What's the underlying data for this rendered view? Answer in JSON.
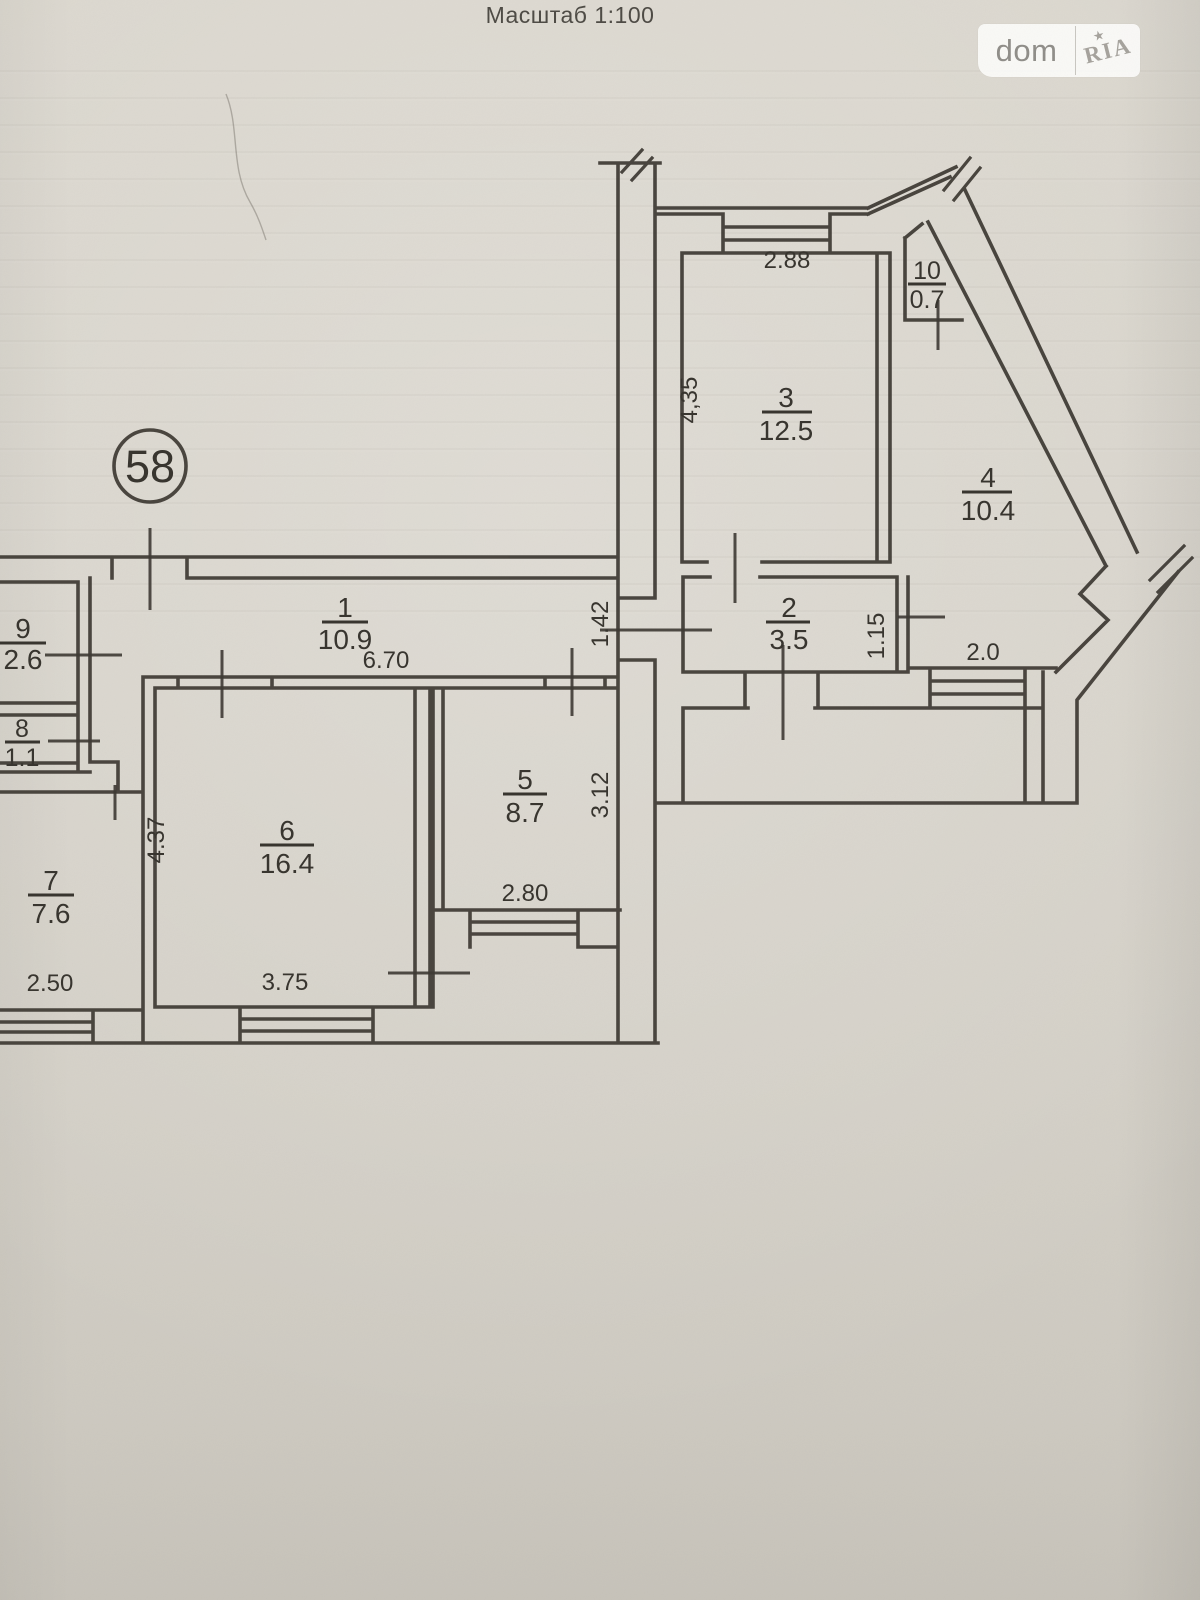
{
  "title": "Масштаб 1:100",
  "watermark": {
    "left": "dom",
    "right": "RIA",
    "star": "★"
  },
  "apartment_badge": "58",
  "rooms": [
    {
      "number": "1",
      "area": "10.9"
    },
    {
      "number": "2",
      "area": "3.5"
    },
    {
      "number": "3",
      "area": "12.5"
    },
    {
      "number": "4",
      "area": "10.4"
    },
    {
      "number": "5",
      "area": "8.7"
    },
    {
      "number": "6",
      "area": "16.4"
    },
    {
      "number": "7",
      "area": "7.6"
    },
    {
      "number": "8",
      "area": "1.1"
    },
    {
      "number": "9",
      "area": "2.6"
    },
    {
      "number": "10",
      "area": "0.7"
    }
  ],
  "dimensions": {
    "d2_88": "2.88",
    "d4_35": "4,35",
    "d6_70": "6.70",
    "d1_42": "1.42",
    "d1_15": "1.15",
    "d2_0": "2.0",
    "d2_80": "2.80",
    "d3_12": "3.12",
    "d3_75": "3.75",
    "d2_50": "2.50",
    "d4_37": "4.37"
  }
}
